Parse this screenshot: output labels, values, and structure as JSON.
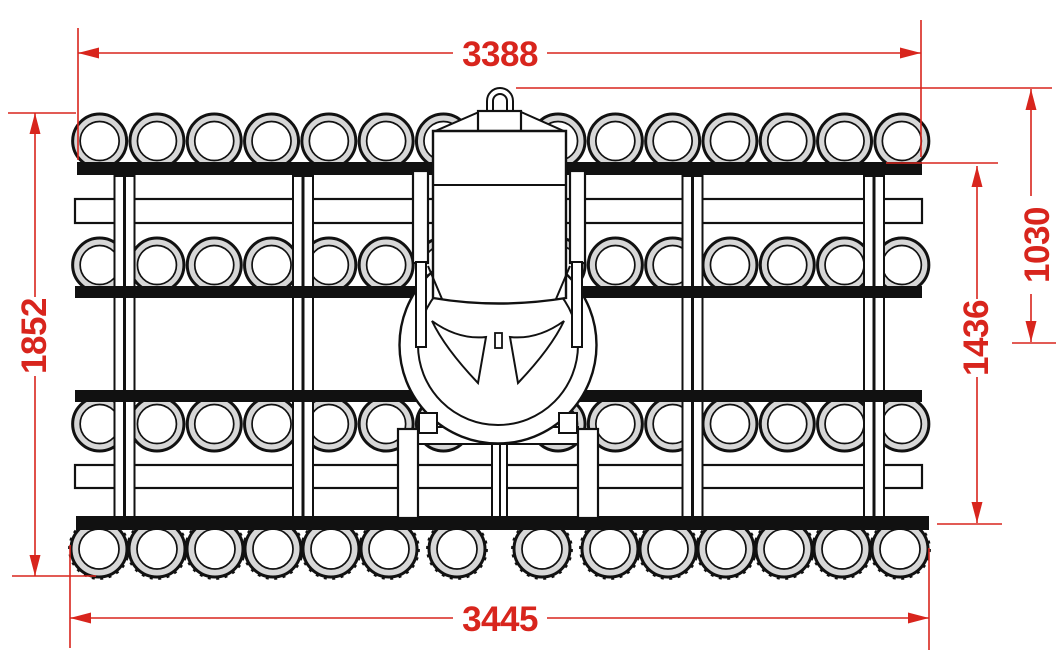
{
  "drawing": {
    "type": "technical-drawing-top-view-roller-implement",
    "dimensions": {
      "overall_width_top": "3388",
      "overall_width_bottom": "3445",
      "overall_length": "1852",
      "frame_length": "1436",
      "hitch_to_axle": "1030"
    },
    "colors": {
      "dimension_red": "#d8251d",
      "outline_black": "#111111",
      "ring_gray": "#d7d7d7"
    }
  }
}
